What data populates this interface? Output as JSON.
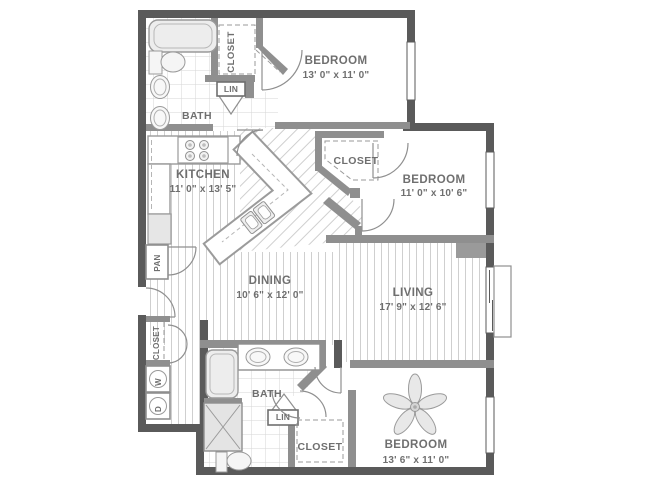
{
  "colors": {
    "wall_dark": "#5a5a5a",
    "wall_light": "#8f8f8f",
    "text": "#6f6f6f",
    "floor_line": "#cfcfcf",
    "fixture_line": "#9a9a9a"
  },
  "rooms": {
    "bedroom_top": {
      "name": "BEDROOM",
      "dims": "13' 0\" x 11' 0\""
    },
    "bedroom_right": {
      "name": "BEDROOM",
      "dims": "11' 0\" x 10' 6\""
    },
    "bedroom_bottom": {
      "name": "BEDROOM",
      "dims": "13' 6\" x 11' 0\""
    },
    "kitchen": {
      "name": "KITCHEN",
      "dims": "11' 0\" x 13' 5\""
    },
    "dining": {
      "name": "DINING",
      "dims": "10' 6\" x 12' 0\""
    },
    "living": {
      "name": "LIVING",
      "dims": "17' 9\" x 12' 6\""
    },
    "bath_top": {
      "name": "BATH"
    },
    "bath_bottom": {
      "name": "BATH"
    }
  },
  "storage": {
    "closet_top": {
      "name": "CLOSET"
    },
    "closet_right": {
      "name": "CLOSET"
    },
    "closet_bottom": {
      "name": "CLOSET"
    },
    "closet_hall": {
      "name": "CLOSET"
    },
    "linen_top": {
      "name": "LIN"
    },
    "linen_bottom": {
      "name": "LIN"
    },
    "pantry": {
      "name": "PAN"
    }
  },
  "appliances": {
    "washer": "W",
    "dryer": "D"
  }
}
